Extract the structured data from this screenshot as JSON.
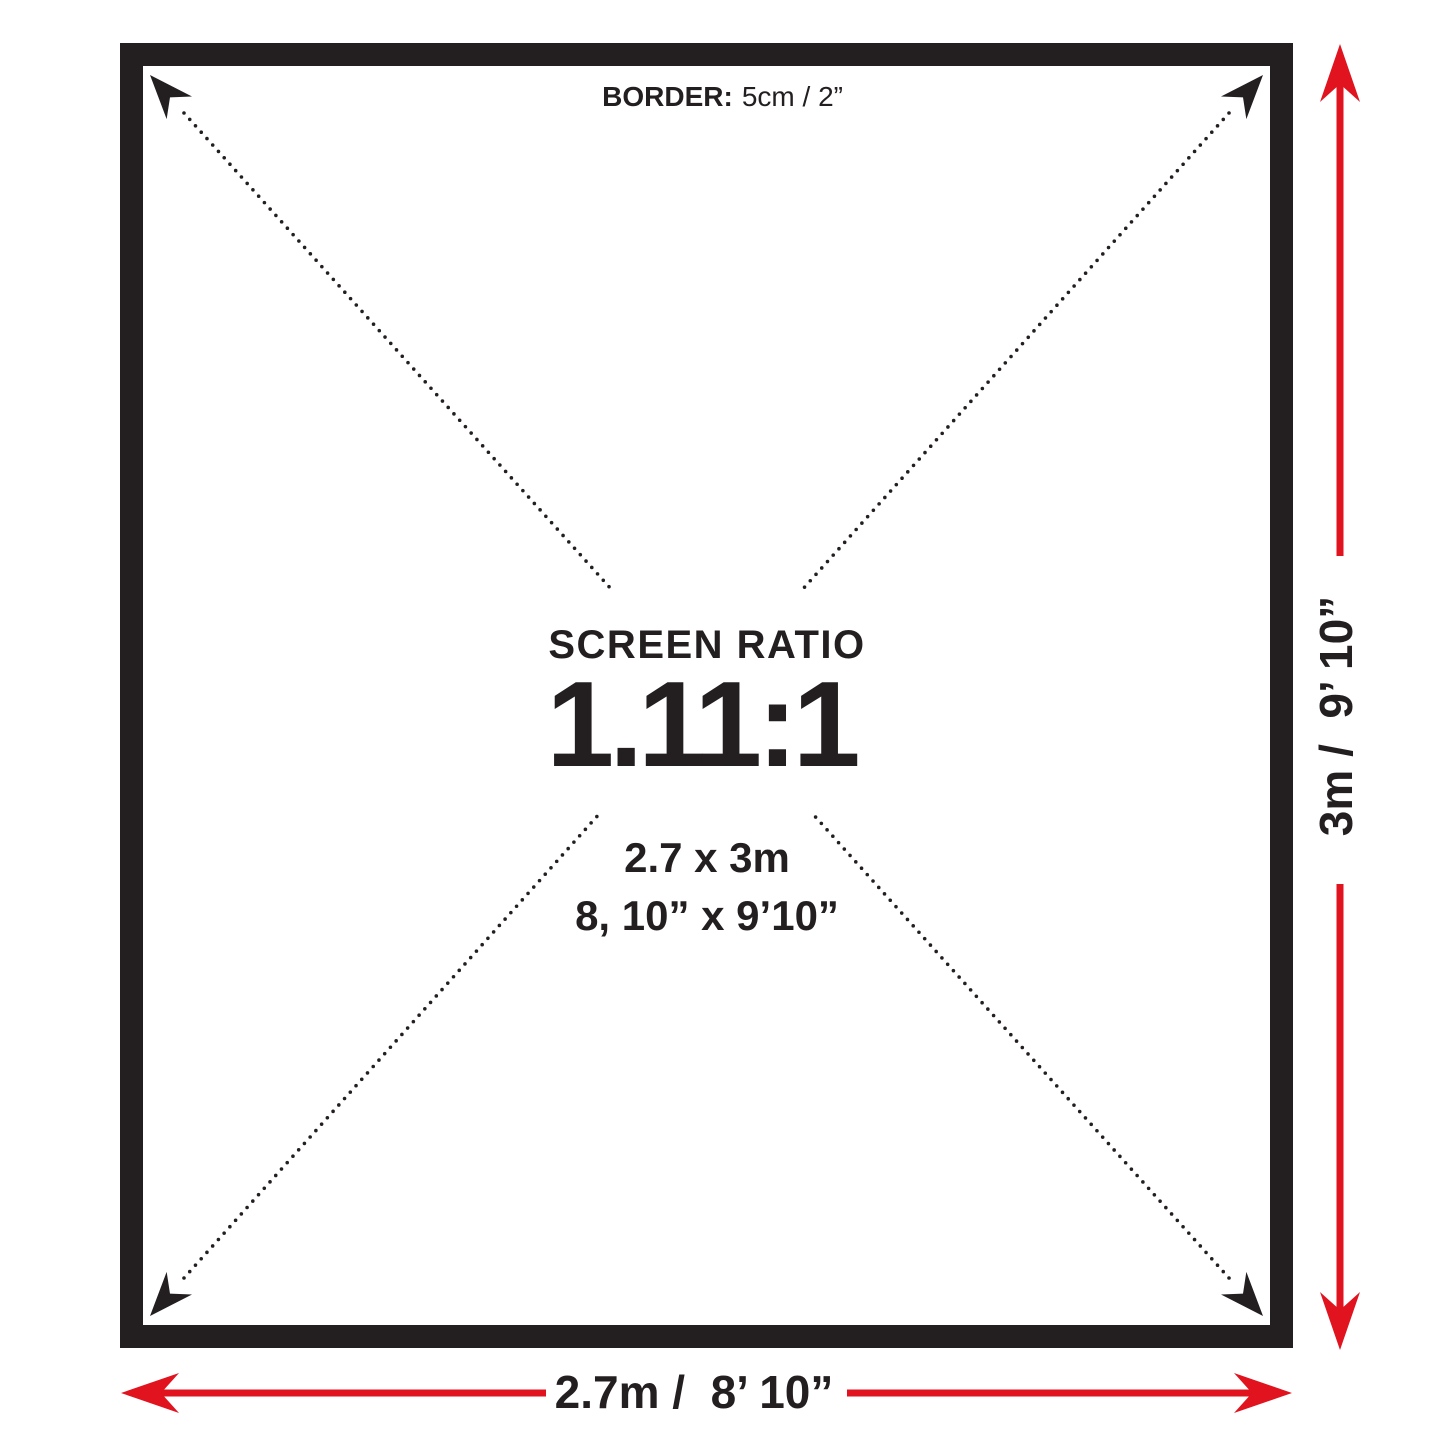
{
  "diagram": {
    "frame": {
      "border_label": "BORDER:",
      "border_value": "5cm / 2”"
    },
    "center": {
      "ratio_title": "SCREEN RATIO",
      "ratio_value": "1.11:1",
      "size_metric": "2.7 x 3m",
      "size_imperial": "8, 10” x 9’10”"
    },
    "dimensions": {
      "width_label": "2.7m /  8’ 10”",
      "height_label": "3m /  9’ 10”"
    },
    "colors": {
      "ink": "#231f20",
      "accent": "#e0131f"
    }
  }
}
